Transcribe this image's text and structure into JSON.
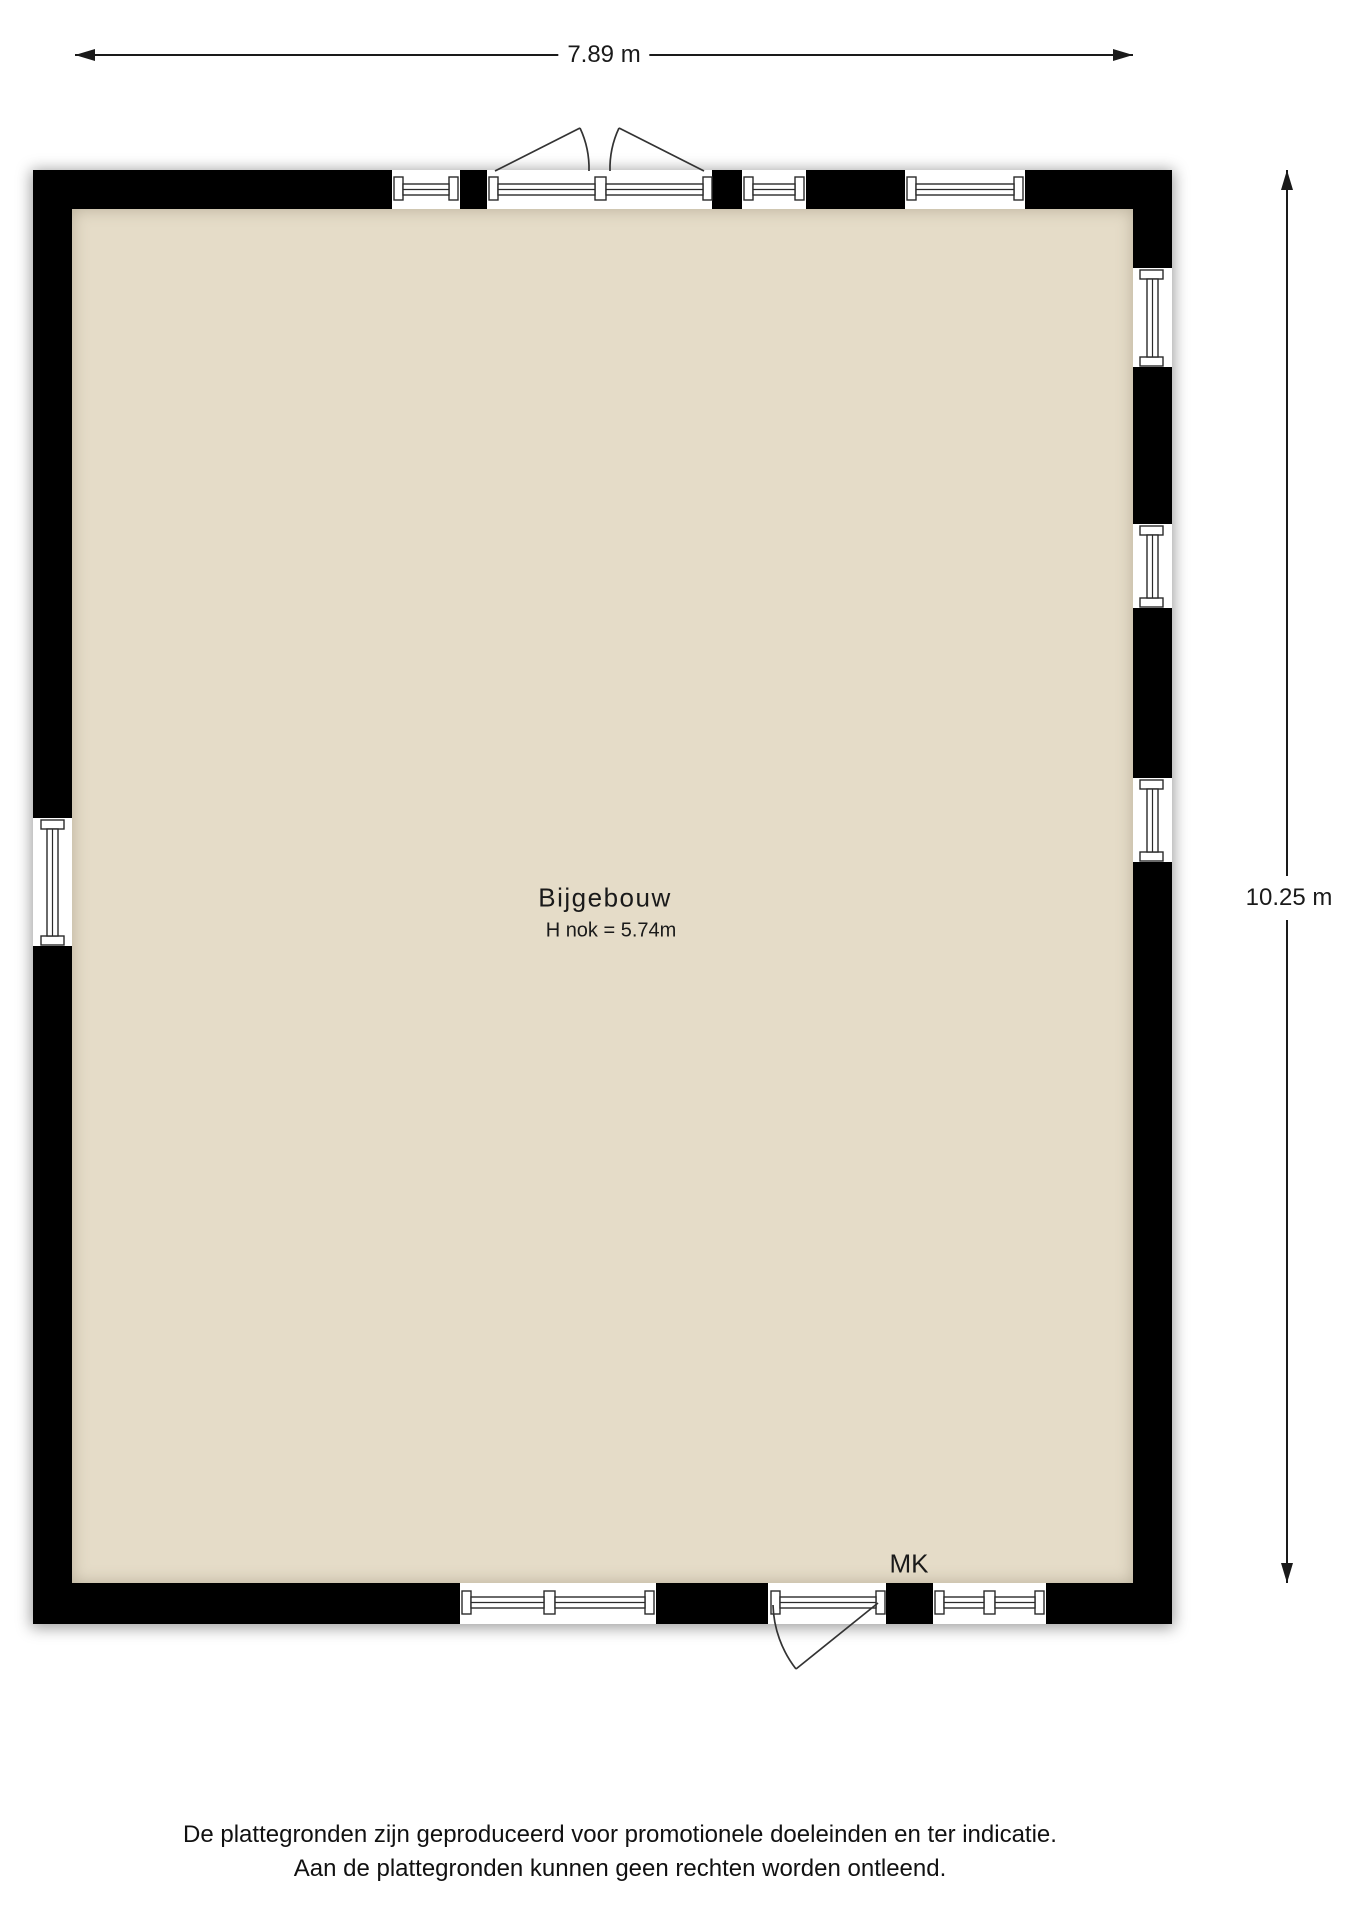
{
  "dimensions": {
    "width_label": "7.89 m",
    "height_label": "10.25 m"
  },
  "room": {
    "name": "Bijgebouw",
    "ridge_height_label": "H nok = 5.74m",
    "meter_cupboard_label": "MK"
  },
  "disclaimer": {
    "line1": "De plattegronden zijn geproduceerd voor promotionele doeleinden en ter indicatie.",
    "line2": "Aan de plattegronden kunnen geen rechten worden ontleend."
  },
  "colors": {
    "wall": "#000000",
    "floor": "#e5dcc8",
    "line": "#1a1a1a",
    "background": "#ffffff"
  },
  "plan": {
    "type": "floorplan",
    "window_count": {
      "top": 3,
      "bottom": 2,
      "left": 1,
      "right": 3
    },
    "doors": [
      {
        "wall": "top",
        "type": "double-outswing"
      },
      {
        "wall": "bottom",
        "type": "single-outswing"
      }
    ]
  }
}
